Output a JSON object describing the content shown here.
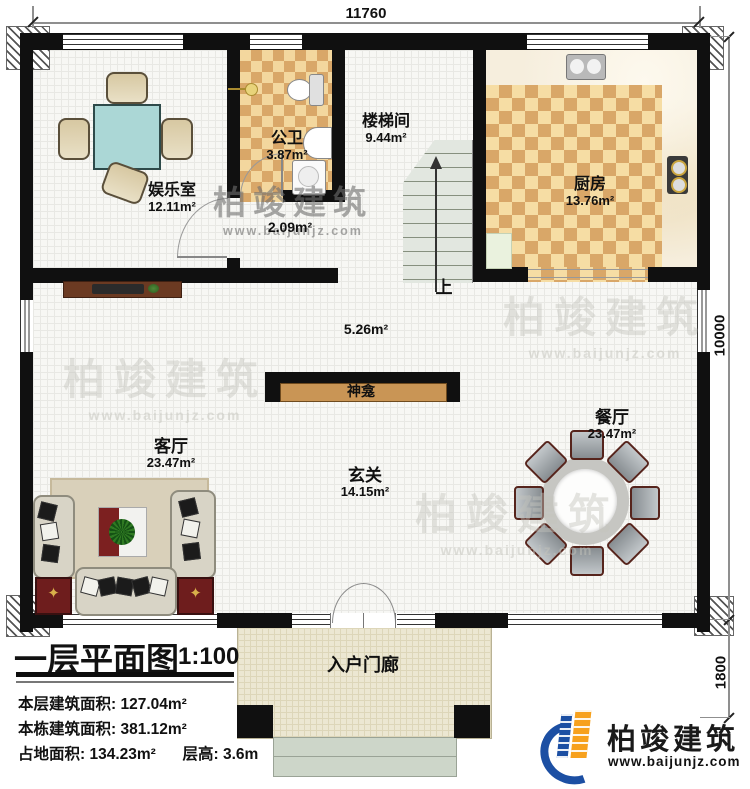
{
  "plan": {
    "dims": {
      "top": "11760",
      "right_main": "10000",
      "right_porch": "1800"
    },
    "rooms": {
      "entertainment": {
        "name": "娱乐室",
        "area": "12.11m²"
      },
      "bathroom": {
        "name": "公卫",
        "area": "3.87m²"
      },
      "corridor": {
        "area": "2.09m²"
      },
      "stairwell": {
        "name": "楼梯间",
        "area": "9.44m²"
      },
      "kitchen": {
        "name": "厨房",
        "area": "13.76m²"
      },
      "hall": {
        "area": "5.26m²"
      },
      "shrine": {
        "name": "神龛"
      },
      "living": {
        "name": "客厅",
        "area": "23.47m²"
      },
      "foyer": {
        "name": "玄关",
        "area": "14.15m²"
      },
      "dining": {
        "name": "餐厅",
        "area": "23.47m²"
      },
      "porch": {
        "name": "入户门廊"
      }
    },
    "stairs": {
      "up_label": "上"
    }
  },
  "title_block": {
    "title": "一层平面图",
    "scale": "1:100",
    "rows": [
      {
        "label": "本层建筑面积:",
        "value": "127.04m²"
      },
      {
        "label": "本栋建筑面积:",
        "value": "381.12m²"
      },
      {
        "label": "占地面积:",
        "value": "134.23m²",
        "label2": "层高:",
        "value2": "3.6m"
      }
    ]
  },
  "branding": {
    "company": "柏竣建筑",
    "website": "www.baijunjz.com"
  },
  "watermark": {
    "company": "柏竣建筑",
    "website": "www.baijunjz.com"
  },
  "colors": {
    "wall": "#101010",
    "checker_light": "#f6dda4",
    "checker_dark": "#d9a768",
    "logo_blue": "#1c4fa3",
    "logo_orange": "#f7a11d",
    "table_teal": "#abd7d6"
  }
}
